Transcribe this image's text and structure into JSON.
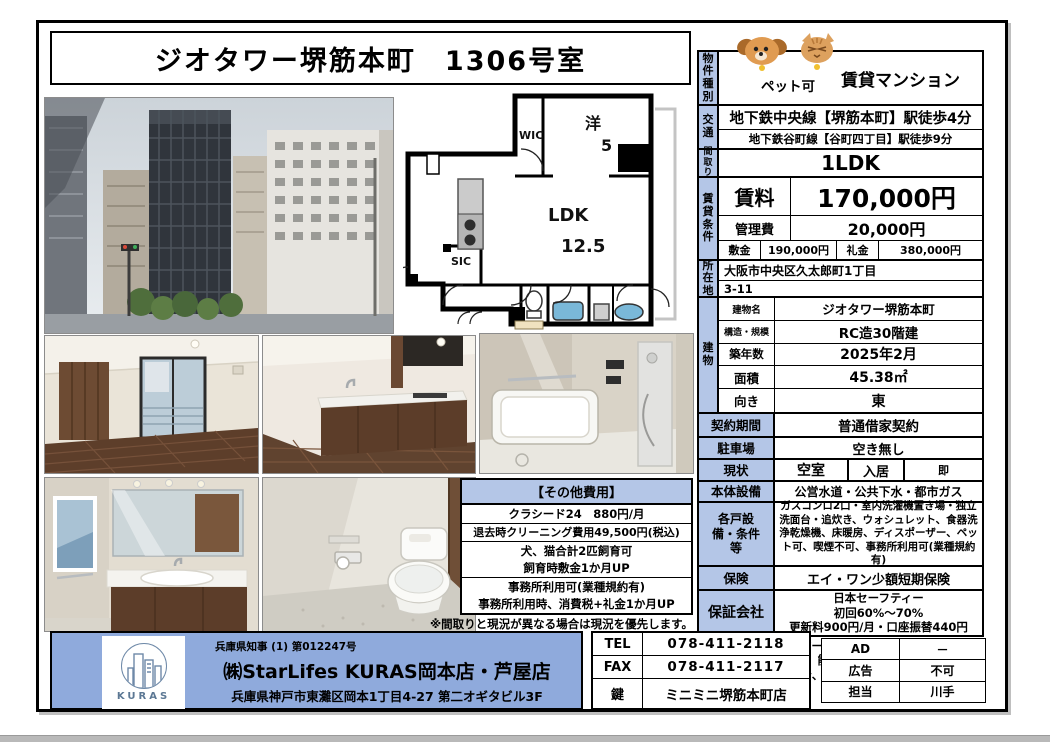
{
  "page": {
    "title": "ジオタワー堺筋本町　1306号室"
  },
  "property": {
    "type_label": "物件種別",
    "pet_badge": "ペット可",
    "type_value": "賃貸マンション",
    "access_label": "交通",
    "access_line1": "地下鉄中央線【堺筋本町】駅徒歩4分",
    "access_line2": "地下鉄谷町線【谷町四丁目】駅徒歩9分",
    "layout_label": "間取り",
    "layout_value": "1LDK",
    "rent_section_label": "賃貸条件",
    "rent_label": "賃料",
    "rent_value": "170,000円",
    "fee_label": "管理費",
    "fee_value": "20,000円",
    "deposit_label": "敷金",
    "deposit_value": "190,000円",
    "key_money_label": "礼金",
    "key_money_value": "380,000円",
    "address_label": "所在地",
    "address_line1": "大阪市中央区久太郎町1丁目",
    "address_line2": "3-11",
    "building_label": "建物",
    "building_rows": [
      {
        "label": "建物名",
        "value": "ジオタワー堺筋本町"
      },
      {
        "label": "構造・規模",
        "value": "RC造30階建"
      },
      {
        "label": "築年数",
        "value": "2025年2月"
      },
      {
        "label": "面積",
        "value": "45.38㎡"
      },
      {
        "label": "向き",
        "value": "東"
      }
    ],
    "contract_label": "契約期間",
    "contract_value": "普通借家契約",
    "parking_label": "駐車場",
    "parking_value": "空き無し",
    "status_label": "現状",
    "status_value": "空室",
    "movein_label": "入居",
    "movein_value": "即",
    "utilities_label": "本体設備",
    "utilities_value": "公営水道・公共下水・都市ガス",
    "equipment_label": "各戸設備・条件等",
    "equipment_value": "ガスコンロ2口・室内洗濯機置き場・独立洗面台・追炊き、ウォシュレット、食器洗浄乾燥機、床暖房、ディスポーザー、ペット可、喫煙不可、事務所利用可(業種規約有)",
    "insurance_label": "保険",
    "insurance_value": "エイ・ワン少額短期保険",
    "guarantor_label": "保証会社",
    "guarantor_line1": "日本セーフティー",
    "guarantor_line2": "初回60%～70%",
    "guarantor_line3": "更新料900円/月・口座振替440円",
    "warranty_note_line1": "食洗器、ディスポーザー、床暖房、ウォシュレットは性能保証無",
    "warranty_note_line2": "1年未満2ヶ月分、2年未満1ヶ月の違約金有"
  },
  "floorplan": {
    "wic": "WIC",
    "western_room": "洋",
    "western_size": "5",
    "ldk": "LDK",
    "ldk_size": "12.5",
    "sic": "SIC"
  },
  "other_costs": {
    "header": "【その他費用】",
    "rows": [
      "クラシード24　880円/月",
      "退去時クリーニング費用49,500円(税込)",
      "犬、猫合計2匹飼育可",
      "飼育時敷金1か月UP",
      "事務所利用可(業種規約有)",
      "事務所利用時、消費税+礼金1か月UP"
    ]
  },
  "plan_note": "※間取りと現況が異なる場合は現況を優先します。",
  "agency": {
    "license": "兵庫県知事 (1) 第012247号",
    "name": "㈱StarLifes KURAS岡本店・芦屋店",
    "address": "兵庫県神戸市東灘区岡本1丁目4-27 第二オギタビル3F",
    "logo_text": "KURAS",
    "tel_label": "TEL",
    "tel": "078-411-2118",
    "fax_label": "FAX",
    "fax": "078-411-2117",
    "key_label": "鍵",
    "key_value": "ミニミニ堺筋本町店"
  },
  "meta": {
    "ad_label": "AD",
    "ad_value": "－",
    "advert_label": "広告",
    "advert_value": "不可",
    "staff_label": "担当",
    "staff_value": "川手"
  },
  "colors": {
    "label_bg": "#b4c6e7",
    "agency_bg": "#8faadc",
    "tub_blue": "#7ab8d8"
  }
}
